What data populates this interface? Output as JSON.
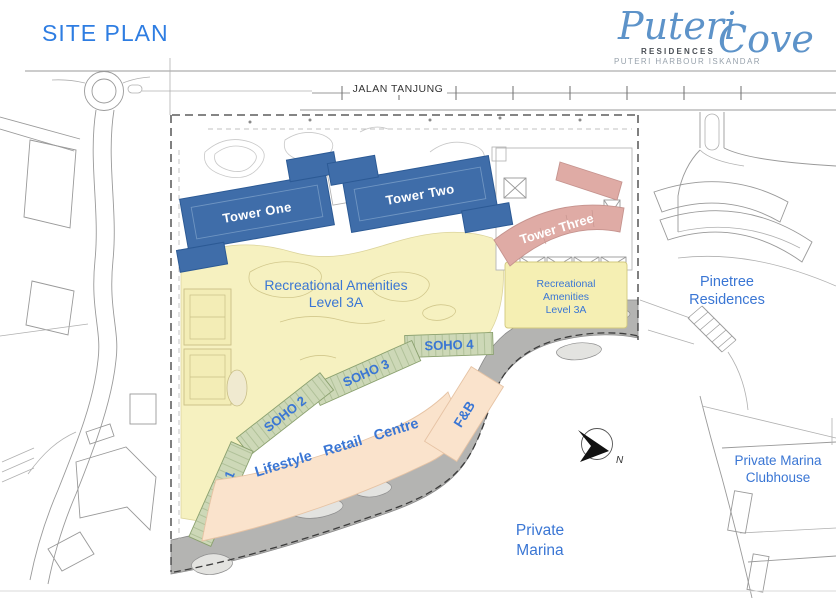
{
  "header": {
    "title": "SITE PLAN"
  },
  "logo": {
    "brand_first": "Puteri",
    "brand_second": "Cove",
    "residences": "RESIDENCES",
    "tagline": "PUTERI HARBOUR ISKANDAR"
  },
  "plan": {
    "road_label": "JALAN TANJUNG",
    "tower_one": "Tower One",
    "tower_two": "Tower Two",
    "tower_three": "Tower Three",
    "amenities_main": {
      "line1": "Recreational Amenities",
      "line2": "Level 3A"
    },
    "amenities_podium": {
      "line1": "Recreational",
      "line2": "Amenities",
      "line3": "Level 3A"
    },
    "soho1": "SOHO 1",
    "soho2": "SOHO 2",
    "soho3": "SOHO 3",
    "soho4": "SOHO 4",
    "retail_label": "Lifestyle Retail Centre",
    "fnb_label": "F&B",
    "pinetree": {
      "line1": "Pinetree",
      "line2": "Residences"
    },
    "clubhouse": {
      "line1": "Private Marina",
      "line2": "Clubhouse"
    },
    "marina": {
      "line1": "Private",
      "line2": "Marina"
    },
    "compass_n": "N"
  },
  "colors": {
    "title_blue": "#2e7de2",
    "label_blue": "#3a76d4",
    "logo_blue": "#5d93c9",
    "tower_blue": "#3f6da9",
    "tower_blue_edge": "#2c5a95",
    "tower_pink": "#dfaba5",
    "tower_pink_edge": "#c5938e",
    "amenities_yellow": "#f6f1c0",
    "soho_green": "#cdd8b7",
    "soho_green_edge": "#8aa06e",
    "retail_peach": "#fae3cc",
    "promenade_gray": "#b4b4b2",
    "boundary_dash": "#3c3c3c"
  }
}
